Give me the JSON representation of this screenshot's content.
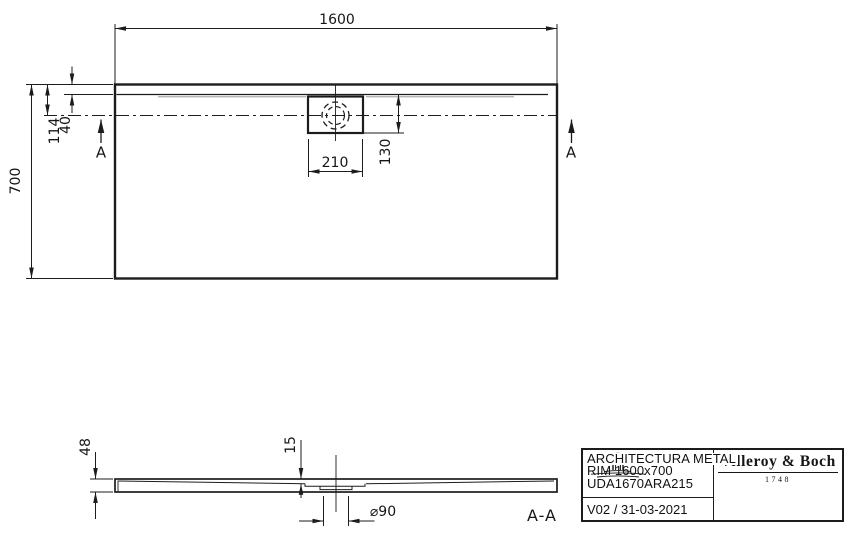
{
  "colors": {
    "ink": "#1c1c1c",
    "background": "#ffffff"
  },
  "drawing": {
    "top_view": {
      "width_dim": "1600",
      "height_dim": "700",
      "edge_to_center_dim": "114",
      "rim_dim": "40",
      "drain_box_width_dim": "210",
      "drain_offset_dim": "130",
      "section_marker_left": "A",
      "section_marker_right": "A"
    },
    "side_view": {
      "height_dim": "48",
      "inner_depth_dim": "15",
      "drain_diameter_dim": "⌀90",
      "section_label": "A-A"
    },
    "title_block": {
      "product_name": "ARCHITECTURA METAL",
      "product_size": "RIM 1600x700",
      "article_number": "UDA1670ARA215",
      "version_date": "V02 / 31-03-2021",
      "brand_name": "Villeroy & Boch",
      "brand_year": "1748"
    }
  }
}
